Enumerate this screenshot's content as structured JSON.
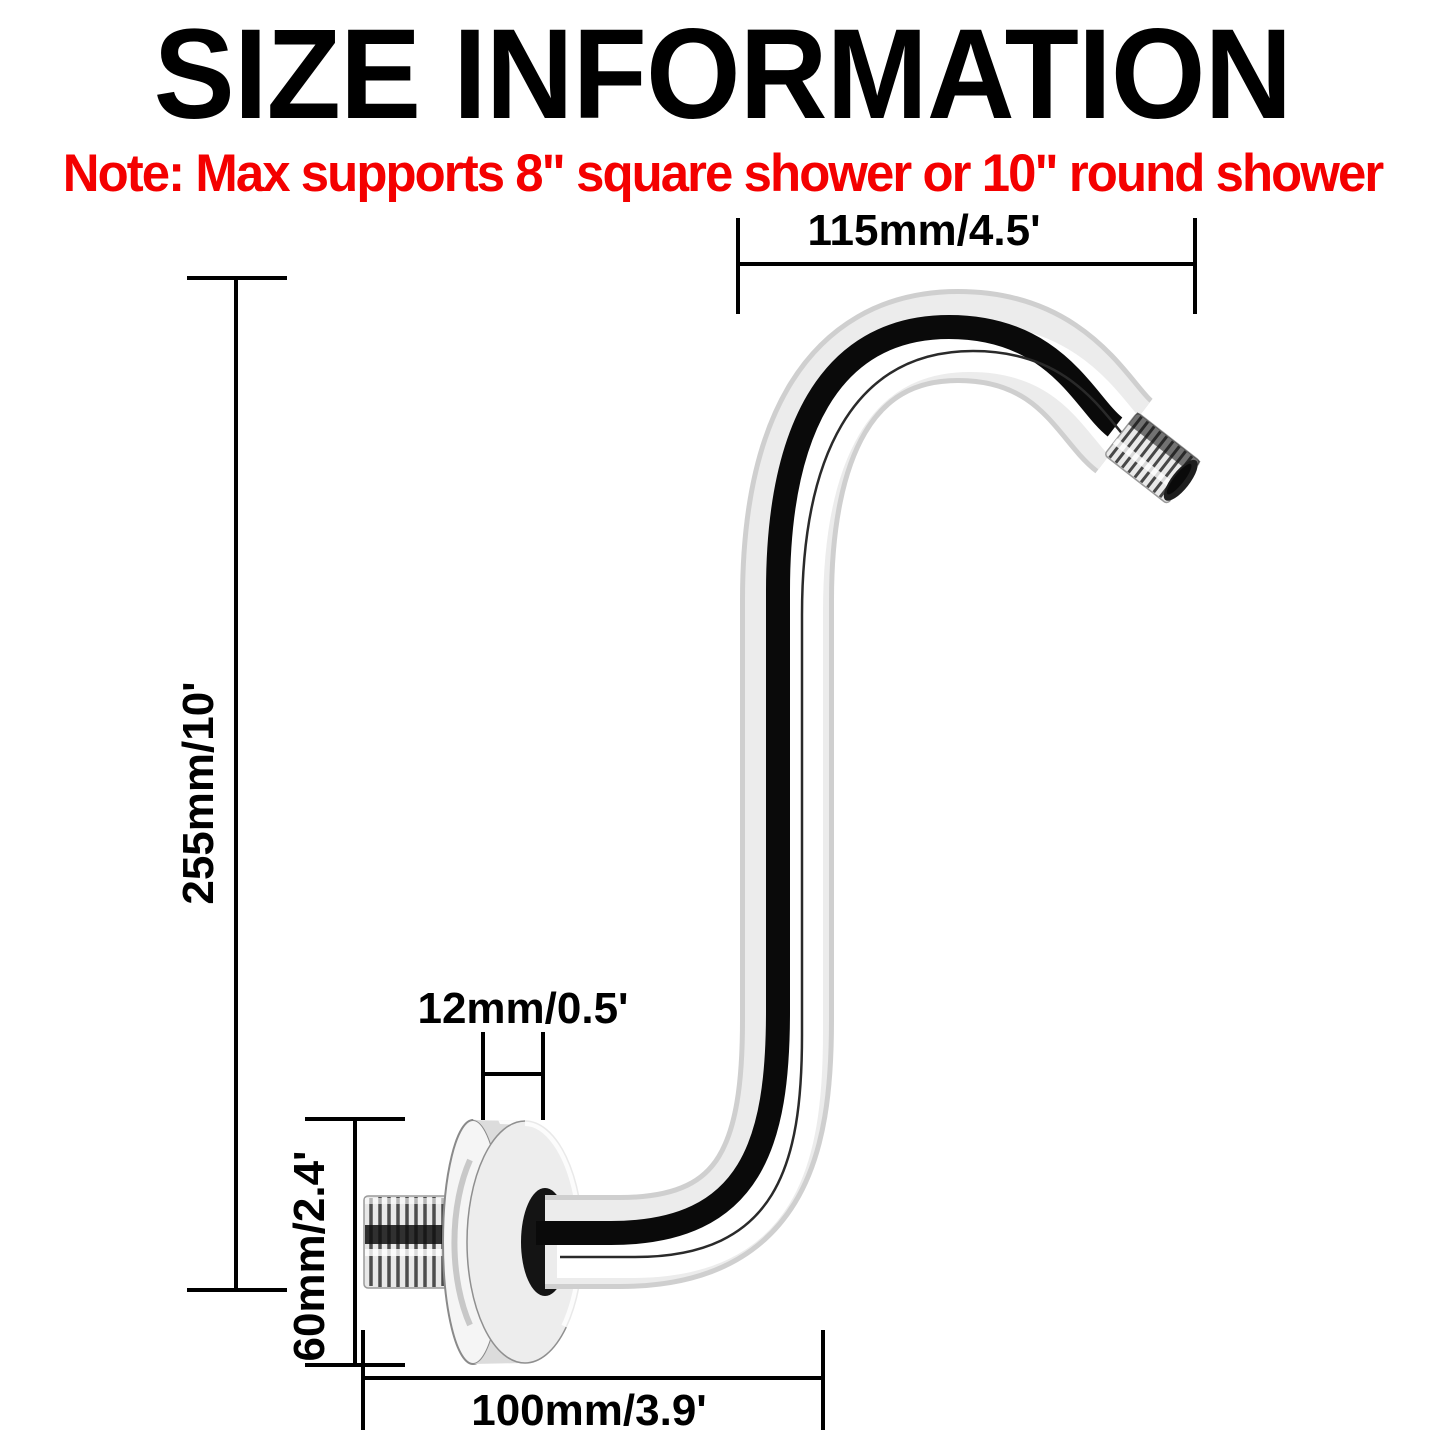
{
  "title": "SIZE INFORMATION",
  "note": "Note: Max supports 8\" square shower or 10\" round shower",
  "colors": {
    "title": "#000000",
    "note": "#f40000",
    "dimension_lines": "#000000",
    "chrome_light": "#f2f2f2",
    "chrome_dark": "#0a0a0a"
  },
  "product": {
    "description": "S-shaped chrome shower head extension arm with round wall flange and threaded ends"
  },
  "dimensions": {
    "top_width": "115mm/4.5'",
    "height": "255mm/10'",
    "flange_thickness": "12mm/0.5'",
    "flange_diameter": "60mm/2.4'",
    "bottom_width": "100mm/3.9'"
  }
}
